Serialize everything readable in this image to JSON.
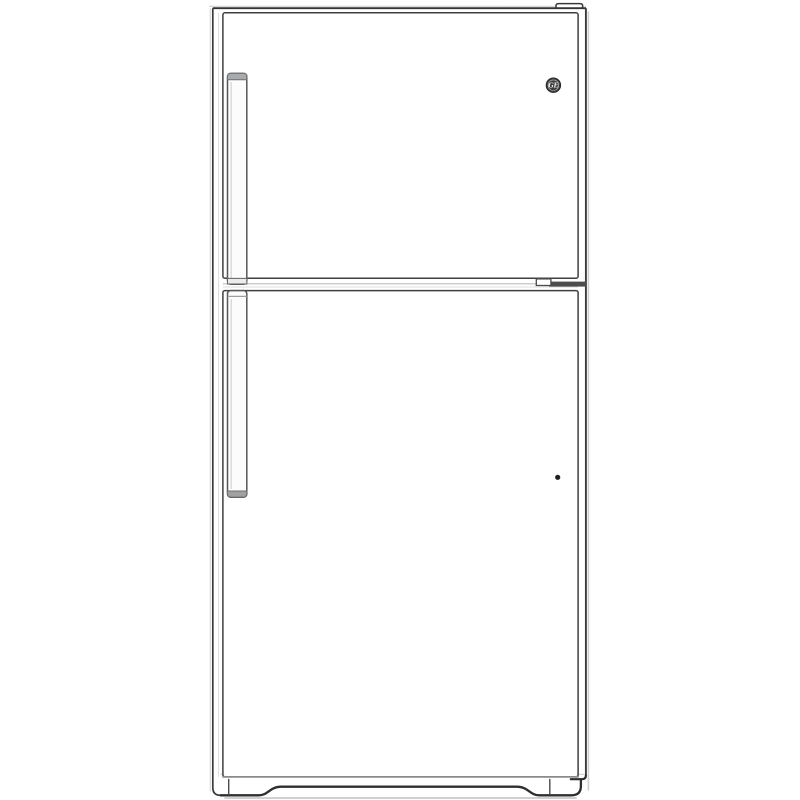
{
  "page": {
    "background": "#ffffff"
  },
  "product": {
    "brand": "GE",
    "image_description": "Front-view line drawing of a GE top-freezer refrigerator"
  },
  "colors": {
    "line_dark": "#3a3a3a",
    "line_medium": "#5a5a5a",
    "line_light": "#c9c9c9",
    "handle_cap": "#a7abad",
    "mid_hinge_band": "#4d4d4d",
    "logo_disc": "#3f3f3f",
    "logo_text": "#f2f2f2",
    "indicator_dot": "#1f1f1f",
    "door_fill": "#ffffff"
  },
  "icons": {
    "brand_logo": "ge-monogram-icon",
    "door_dot": "door-indicator-dot"
  }
}
